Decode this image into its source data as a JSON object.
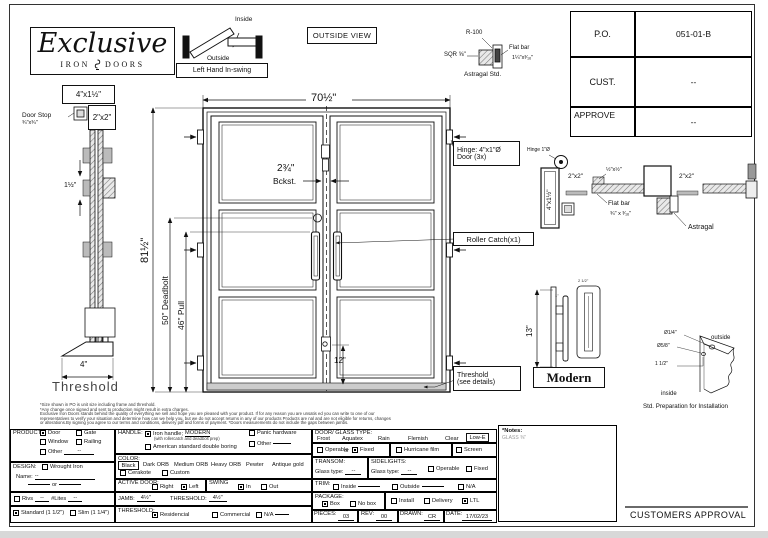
{
  "logo": {
    "title": "Exclusive",
    "iron": "IRON",
    "doors": "DOORS"
  },
  "swing": {
    "inside": "Inside",
    "outside": "Outside",
    "caption": "Left Hand In-swing"
  },
  "outside_view": "OUTSIDE VIEW",
  "astragal_std": {
    "r100": "R-100",
    "sqr": "SQR ⅝\"",
    "flat_bar": "Flat bar",
    "size": "1¼\"x³⁄₁₆\"",
    "caption": "Astragal Std."
  },
  "po_table": {
    "po": "P.O.",
    "po_value": "051-01-B",
    "cust": "CUST.",
    "cust_value": "--",
    "approve": "APPROVE",
    "approve_value": "--"
  },
  "jamb_section": {
    "jamb": "4\"x1½\"",
    "door_stop": "Door Stop",
    "door_stop_size": "¾\"x¾\"",
    "tube": "2\"x2\"",
    "hinge_gap": "1½\"",
    "width": "4\"",
    "caption": "Threshold"
  },
  "elevation": {
    "width": "70½\"",
    "height": "81½\"",
    "deadbolt": "50\" Deadbolt",
    "pull": "46\" Pull",
    "backset": "2¾\"",
    "backset_label": "Bckst.",
    "lock_height": "12\"",
    "hinge_note_1": "Hinge: 4\"x1\"Ø",
    "hinge_note_2": "Door (3x)",
    "roller_note": "Roller Catch(x1)",
    "threshold_note_1": "Threshold",
    "threshold_note_2": "(see details)"
  },
  "head_section": {
    "hinge": "Hinge 1\"Ø",
    "jamb": "4\"x1½\"",
    "tube_left": "2\"x2\"",
    "tube_right": "2\"x2\"",
    "corner": "½\"x½\"",
    "flat_bar": "Flat bar",
    "flat_bar_size": "¾\" x ³⁄₁₆\"",
    "astragal": "Astragal"
  },
  "handle_detail": {
    "height": "13\"",
    "dim_small": "1\"",
    "dim_width": "2 1/2\"",
    "style": "Modern"
  },
  "prep": {
    "hole1": "Ø1/4\"",
    "hole2": "Ø5/8\"",
    "offset": "1 1/2\"",
    "outside": "outside",
    "inside": "inside",
    "caption": "Std. Preparation for Installation"
  },
  "disclaimer": {
    "l1": "*Size shown in PO is unit size including frame and threshold.",
    "l2": "*Any change once signed and sent to production might result in extra charges.",
    "l3": "Exclusive Iron Doors stands behind the quality of everything we sell and hope you are pleased with your product. If for any reason you are unsatis  ed you can write to one of our",
    "l4": "representatives to verify your situation and determine how can we help you, but we do not accept returns in any of our products Products are   nal and are not eligible for returns, changes",
    "l5": "or alterations.By signing you agree to our terms and conditions, delivery pdf and forms of payment. *Doors measurements do not include the gaps between jambs."
  },
  "form": {
    "product": {
      "label": "PRODUCT:",
      "door": {
        "label": "Door",
        "checked": true
      },
      "gate": {
        "label": "Gate",
        "checked": false
      },
      "window": {
        "label": "Window",
        "checked": false
      },
      "railing": {
        "label": "Railing",
        "checked": false
      },
      "other": {
        "label": "Other",
        "checked": false
      },
      "other_value": "--"
    },
    "design": {
      "label": "DESIGN:",
      "wrought": {
        "label": "Wrought Iron",
        "checked": false
      },
      "name_label": "Name:",
      "name_value": "--",
      "or": "or"
    },
    "rivs": {
      "rivs": {
        "label": "Rivs",
        "checked": false
      },
      "rivs_value": "--",
      "lites_label": "#Lites",
      "lites_value": "--"
    },
    "frame": {
      "standard": {
        "label": "Standard (1 1/2\")",
        "checked": true
      },
      "slim": {
        "label": "Slim (1 1/4\")",
        "checked": false
      }
    },
    "handle": {
      "label": "HANDLE:",
      "iron": {
        "label": "Iron handle;",
        "style": "MODERN",
        "checked": true
      },
      "iron_sub": "(with rollercatch and deadbolt prep)",
      "american": {
        "label": "American standard double boring",
        "checked": false
      },
      "panic": {
        "label": "Panic hardware",
        "checked": false
      },
      "other": {
        "label": "Other",
        "checked": false
      }
    },
    "color": {
      "label": "COLOR:",
      "selected": "Black",
      "o1": "Dark ORB",
      "o2": "Medium ORB",
      "o3": "Heavy ORB",
      "o4": "Pewter",
      "o5": "Antique gold",
      "cerakote": {
        "label": "Cerakote",
        "checked": false
      },
      "custom": {
        "label": "Custom",
        "checked": false
      }
    },
    "active_door": {
      "label": "ACTIVE DOOR:",
      "right": {
        "label": "Right",
        "checked": false
      },
      "left": {
        "label": "Left",
        "checked": true
      }
    },
    "swing": {
      "label": "SWING",
      "in": {
        "label": "In",
        "checked": true
      },
      "out": {
        "label": "Out",
        "checked": false
      }
    },
    "jamb_row": {
      "jamb_label": "JAMB:",
      "jamb_value": "4½\"",
      "threshold_label": "THRESHOLD:",
      "threshold_value": "4½\""
    },
    "threshold_row": {
      "label": "THRESHOLD:",
      "residential": {
        "label": "Residencial",
        "checked": true
      },
      "commercial": {
        "label": "Commercial",
        "checked": false
      },
      "na": {
        "label": "N/A",
        "checked": false
      }
    },
    "glass": {
      "label": "DOOR/ GLASS TYPE:",
      "o1": "Frost",
      "o2": "Aquatex",
      "o3": "Rain",
      "o4": "Flemish",
      "o5": "Clear",
      "selected": "Low-E",
      "operable": {
        "label": "Operable",
        "checked": false
      },
      "or": "or",
      "fixed": {
        "label": "Fixed",
        "checked": true
      },
      "hurricane": {
        "label": "Hurricane film",
        "checked": false
      },
      "screen": {
        "label": "Screen",
        "checked": false
      }
    },
    "transom": {
      "label": "TRANSOM:",
      "glass_label": "Glass type:",
      "glass_value": "--"
    },
    "sidelights": {
      "label": "SIDELIGHTS:",
      "glass_label": "Glass type:",
      "glass_value": "--",
      "operable": {
        "label": "Operable",
        "checked": false
      },
      "fixed": {
        "label": "Fixed",
        "checked": false
      }
    },
    "trim": {
      "label": "TRIM:",
      "inside": {
        "label": "Inside",
        "checked": false
      },
      "outside": {
        "label": "Outside",
        "checked": false
      },
      "na": {
        "label": "N/A",
        "checked": false
      }
    },
    "package": {
      "label": "PACKAGE:",
      "box": {
        "label": "Box",
        "checked": true
      },
      "nobox": {
        "label": "No box",
        "checked": false
      },
      "install": {
        "label": "Install",
        "checked": false
      },
      "delivery": {
        "label": "Delivery",
        "checked": false
      },
      "ltl": {
        "label": "LTL",
        "checked": true
      }
    },
    "meta": {
      "pieces_label": "PIECES:",
      "pieces": "03",
      "rev_label": "REV:",
      "rev": "00",
      "drawn_label": "DRAWN:",
      "drawn": "CR",
      "date_label": "DATE:",
      "date": "17/02/23"
    }
  },
  "notes": {
    "title": "*Notes:",
    "body": "GLASS ⅜\""
  },
  "approval": "CUSTOMERS APPROVAL"
}
